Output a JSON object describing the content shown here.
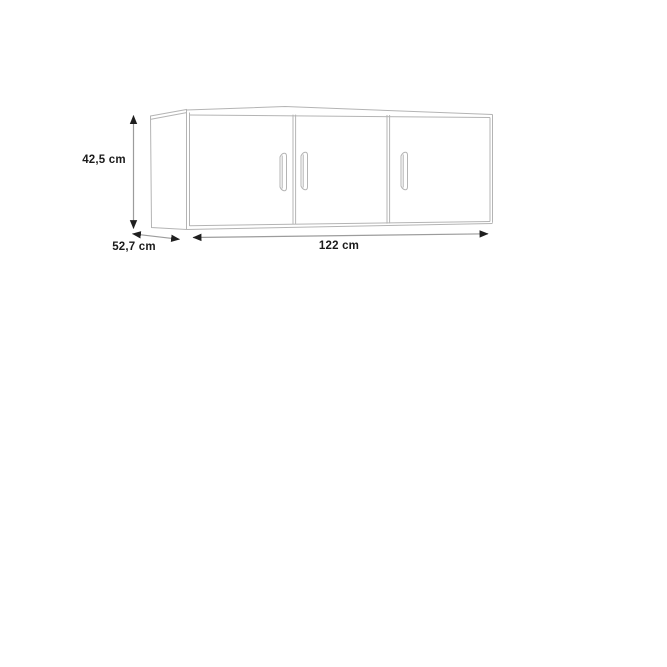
{
  "diagram": {
    "type": "furniture-dimension-diagram",
    "cabinet": {
      "doors": 3,
      "handles": 3
    },
    "labels": {
      "height": "42,5 cm",
      "depth": "52,7 cm",
      "width": "122 cm"
    },
    "colors": {
      "bg": "#ffffff",
      "outline": "#b4b4b4",
      "shaft": "#9c9c9c",
      "arrowhead": "#1f1f1f",
      "label": "#1b1b1b"
    }
  }
}
